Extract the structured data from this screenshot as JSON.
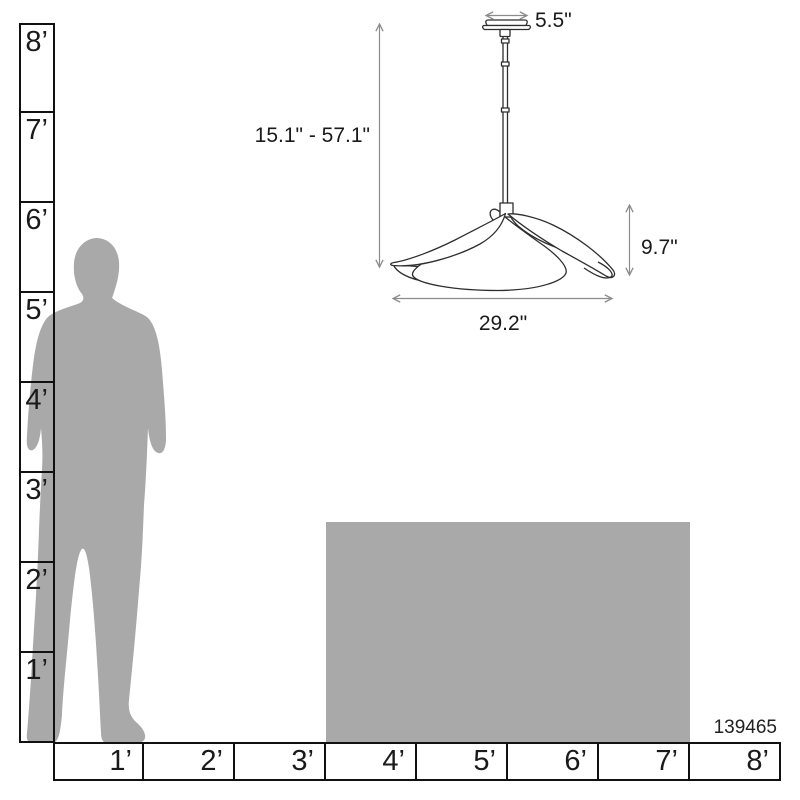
{
  "colors": {
    "line": "#111111",
    "text": "#1a1a1a",
    "silhouette": "#a9a9a9",
    "block": "#a9a9a9",
    "lamp": "#2e2e2e",
    "dim": "#8c8c8c"
  },
  "rulers": {
    "vertical": {
      "labels": [
        "8’",
        "7’",
        "6’",
        "5’",
        "4’",
        "3’",
        "2’",
        "1’"
      ]
    },
    "horizontal": {
      "labels": [
        "1’",
        "2’",
        "3’",
        "4’",
        "5’",
        "6’",
        "7’",
        "8’"
      ]
    }
  },
  "fixture": {
    "canopy_width": "5.5\"",
    "height_range": "15.1\" - 57.1\"",
    "shade_height": "9.7\"",
    "shade_width": "29.2\""
  },
  "product_code": "139465"
}
